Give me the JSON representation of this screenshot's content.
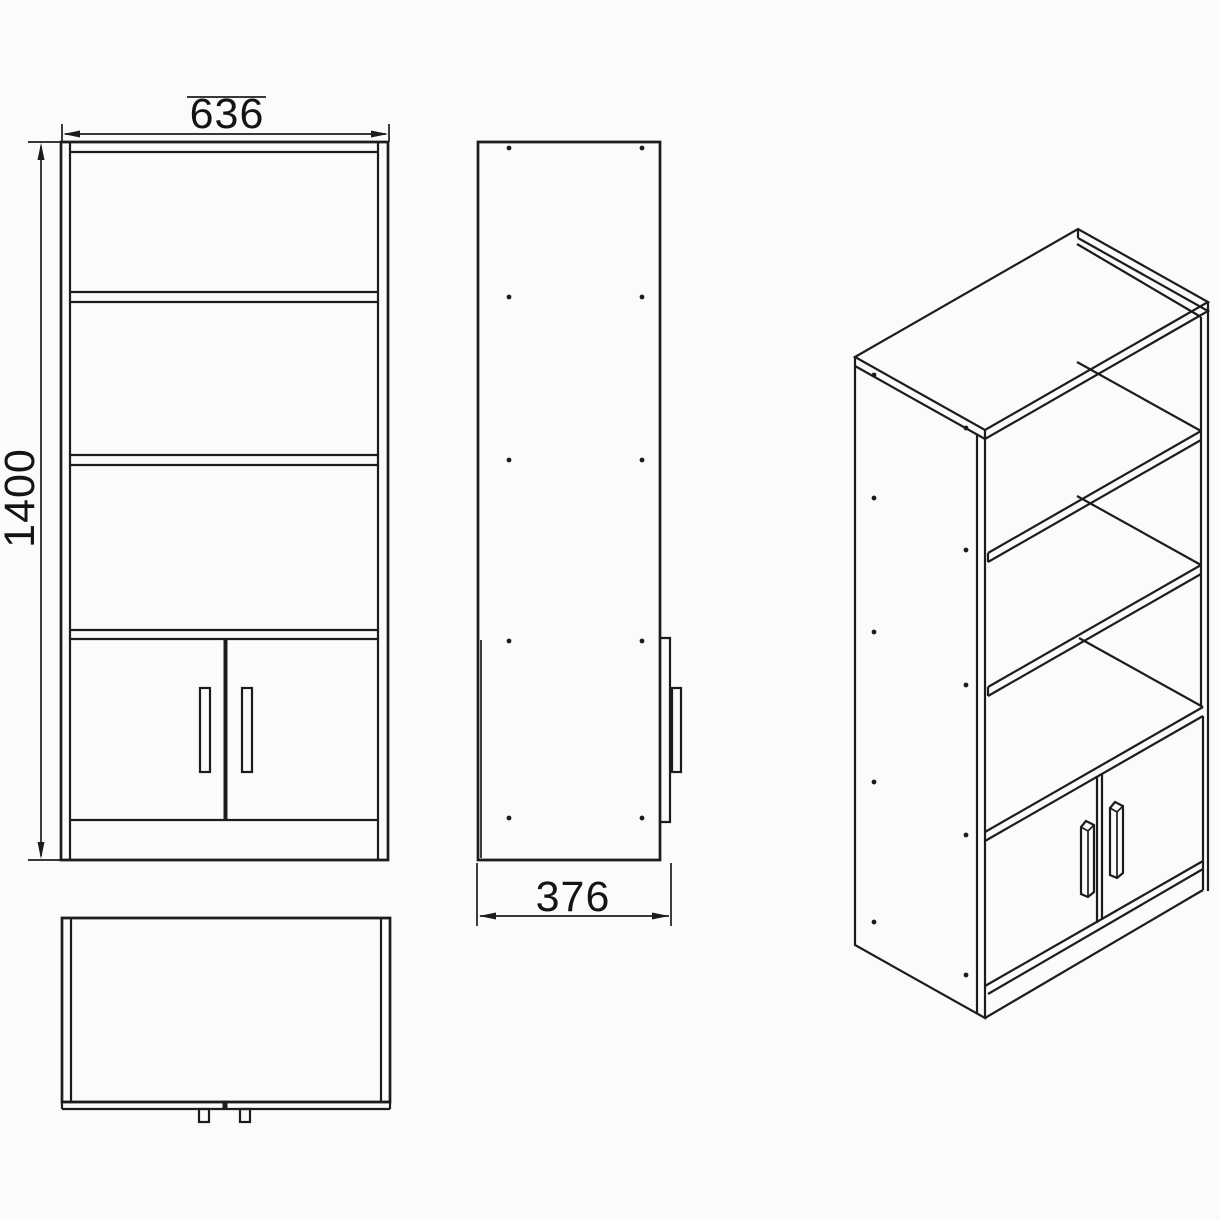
{
  "page": {
    "background": "#fbfbfa",
    "line_color": "#1c1c1c",
    "text_color": "#141414",
    "description": "Technical line drawing of a bookcase cabinet with three open shelves and a two-door base cabinet, shown in front elevation, side elevation, plan view and isometric projection"
  },
  "dimensions": {
    "width_mm": "636",
    "height_mm": "1400",
    "depth_mm": "376"
  },
  "views": {
    "front": {
      "name": "front-elevation",
      "open_compartments": 3,
      "doors": 2,
      "door_handles": 2
    },
    "side": {
      "name": "side-elevation",
      "dowel_hole_pairs": 5,
      "door_profile_visible": true
    },
    "plan": {
      "name": "plan-view",
      "protruding_handles": 2
    },
    "isometric": {
      "name": "isometric-projection",
      "shelves_visible": 3,
      "doors": 2,
      "dowel_holes": 10
    }
  }
}
